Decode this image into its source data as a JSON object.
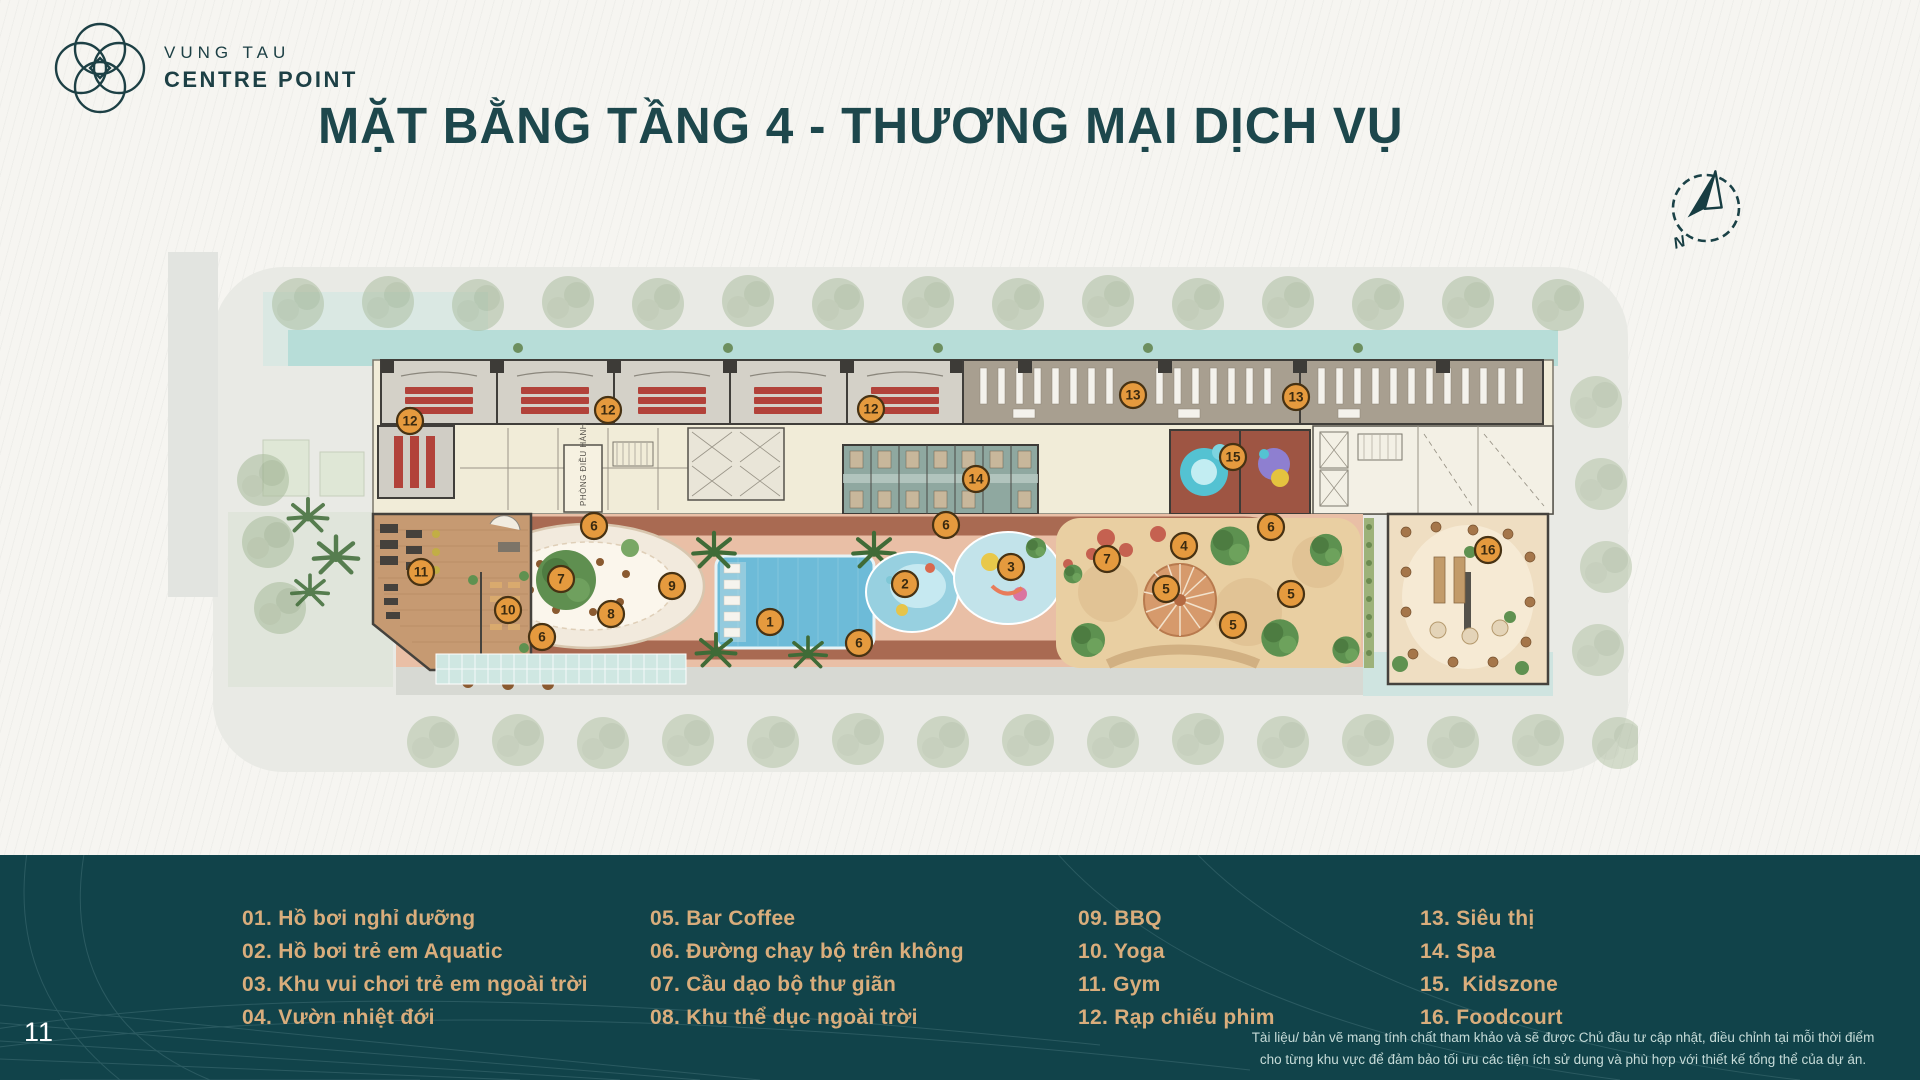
{
  "brand": {
    "name_line1": "VUNG TAU",
    "name_line2": "CENTRE POINT",
    "color": "#1d4045"
  },
  "title": "MẶT BẰNG TẦNG 4 - THƯƠNG MẠI DỊCH VỤ",
  "title_color": "#1d474c",
  "compass": {
    "label": "N"
  },
  "page_number": "11",
  "plan": {
    "room_label": "PHÒNG ĐIỀU HÀNH",
    "marker_style": {
      "fill": "#e59a3e",
      "stroke": "#473213",
      "text": "#3a2a10"
    },
    "markers": [
      {
        "n": "1",
        "x": 602,
        "y": 410
      },
      {
        "n": "2",
        "x": 737,
        "y": 372
      },
      {
        "n": "3",
        "x": 843,
        "y": 355
      },
      {
        "n": "4",
        "x": 1016,
        "y": 334
      },
      {
        "n": "5",
        "x": 998,
        "y": 377
      },
      {
        "n": "5",
        "x": 1065,
        "y": 413
      },
      {
        "n": "5",
        "x": 1123,
        "y": 382
      },
      {
        "n": "6",
        "x": 426,
        "y": 314
      },
      {
        "n": "6",
        "x": 778,
        "y": 313
      },
      {
        "n": "6",
        "x": 1103,
        "y": 315
      },
      {
        "n": "6",
        "x": 374,
        "y": 425
      },
      {
        "n": "6",
        "x": 691,
        "y": 431
      },
      {
        "n": "7",
        "x": 393,
        "y": 367
      },
      {
        "n": "7",
        "x": 939,
        "y": 347
      },
      {
        "n": "8",
        "x": 443,
        "y": 402
      },
      {
        "n": "9",
        "x": 504,
        "y": 374
      },
      {
        "n": "10",
        "x": 340,
        "y": 398
      },
      {
        "n": "11",
        "x": 253,
        "y": 360
      },
      {
        "n": "12",
        "x": 242,
        "y": 209
      },
      {
        "n": "12",
        "x": 440,
        "y": 198
      },
      {
        "n": "12",
        "x": 703,
        "y": 197
      },
      {
        "n": "13",
        "x": 965,
        "y": 183
      },
      {
        "n": "13",
        "x": 1128,
        "y": 185
      },
      {
        "n": "14",
        "x": 808,
        "y": 267
      },
      {
        "n": "15",
        "x": 1065,
        "y": 245
      },
      {
        "n": "16",
        "x": 1320,
        "y": 338
      }
    ]
  },
  "legend": {
    "text_color": "#d9ad7c",
    "background": "#11434a",
    "columns": [
      [
        "01. Hồ bơi nghỉ dưỡng",
        "02. Hồ bơi trẻ em Aquatic",
        "03. Khu vui chơi trẻ em ngoài trời",
        "04. Vườn nhiệt đới"
      ],
      [
        "05. Bar Coffee",
        "06. Đường chạy bộ trên không",
        "07. Cầu dạo bộ thư giãn",
        "08. Khu thể dục ngoài trời"
      ],
      [
        "09. BBQ",
        "10. Yoga",
        "11. Gym",
        "12. Rạp chiếu phim"
      ],
      [
        "13. Siêu thị",
        "14. Spa",
        "15.  Kidszone",
        "16. Foodcourt"
      ]
    ]
  },
  "disclaimer": {
    "line1": "Tài liệu/ bản vẽ mang tính chất tham khảo và sẽ được Chủ đầu tư cập nhật, điều chỉnh tại mỗi thời điểm",
    "line2": "cho từng khu vực để đảm bảo tối ưu các tiện ích sử dụng và phù hợp với thiết kế tổng thể của dự án."
  }
}
